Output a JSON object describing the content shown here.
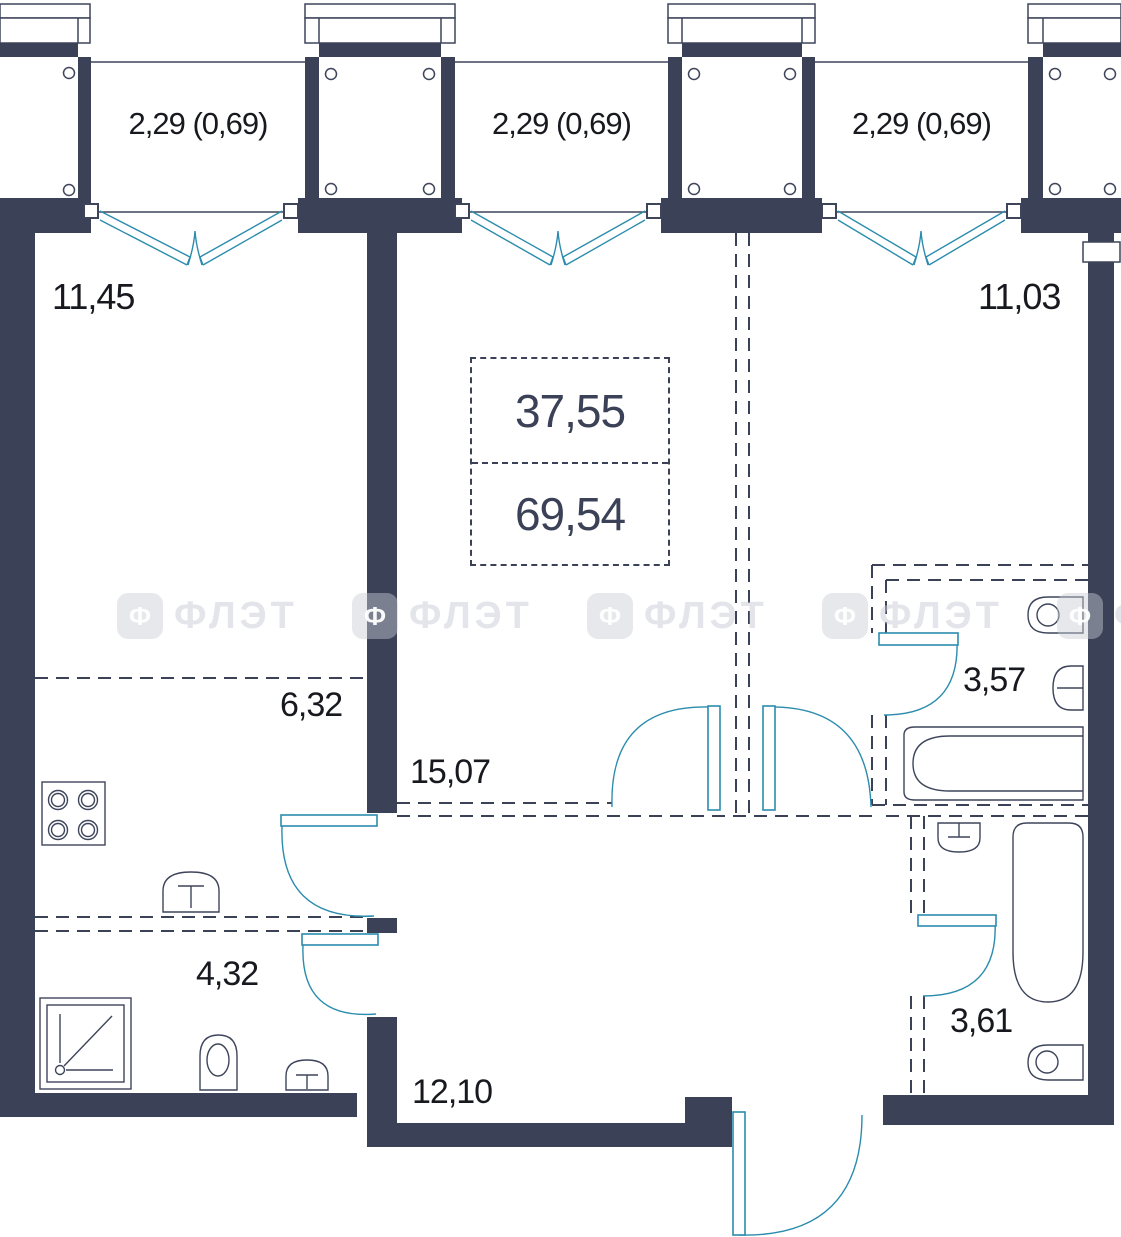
{
  "plan": {
    "watermark": {
      "glyph": "Ф",
      "text": "ФЛЭТ"
    },
    "summary": {
      "living_area": "37,55",
      "total_area": "69,54"
    },
    "balconies": [
      {
        "label": "2,29 (0,69)"
      },
      {
        "label": "2,29 (0,69)"
      },
      {
        "label": "2,29 (0,69)"
      }
    ],
    "rooms": [
      {
        "id": "living-left",
        "area": "11,45"
      },
      {
        "id": "living-right",
        "area": "11,03"
      },
      {
        "id": "kitchen",
        "area": "6,32"
      },
      {
        "id": "hallway",
        "area": "15,07"
      },
      {
        "id": "sanitary-left",
        "area": "4,32"
      },
      {
        "id": "hallway-lower",
        "area": "12,10"
      },
      {
        "id": "bathroom",
        "area": "3,57"
      },
      {
        "id": "wc",
        "area": "3,61"
      }
    ],
    "colors": {
      "wall": "#3b4257",
      "door_accent": "#2b8cad",
      "label_text": "#17191f",
      "summary_text": "#3b4156"
    }
  }
}
